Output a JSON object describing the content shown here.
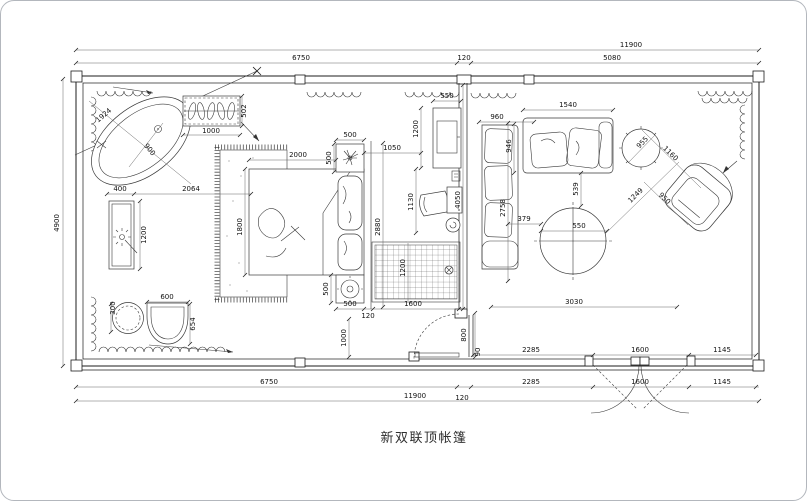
{
  "title": "新双联顶帐篷",
  "dims": {
    "top_overall": "11900",
    "top_left": "6750",
    "top_mid": "120",
    "top_right": "5080",
    "left_height": "4900",
    "bottom_left": "6750",
    "bottom_overall": "11900",
    "bottom_gap": "120",
    "bottom_out_a": "2285",
    "bottom_out_b": "1600",
    "bottom_out_c": "1145",
    "bottom_in_a": "2285",
    "bottom_in_b": "1600",
    "bottom_in_c": "1145",
    "living_width": "3030",
    "living_door": "800",
    "living_door_gap": "90",
    "tub_diag": "1924",
    "tub_width": "900",
    "vanity_offset": "400",
    "vanity_to_rug": "2064",
    "vanity_length": "1200",
    "stool_dia": "300",
    "toilet_width": "600",
    "toilet_depth": "654",
    "wardrobe_width": "1000",
    "wardrobe_depth": "502",
    "bed_length": "2000",
    "bed_width": "1800",
    "nightstand_top_w": "500",
    "nightstand_top_d": "500",
    "nightstand_bot_d": "500",
    "nightstand_bot_w": "500",
    "bed_wall": "2880",
    "tv_offset": "1050",
    "tv_width": "550",
    "tv_height": "1200",
    "desk": "1130",
    "shower_width": "1600",
    "shower_depth": "1200",
    "shower_gap": "120",
    "door_width": "1000",
    "sofa_side": "960",
    "sofa_top": "1540",
    "sofa_depth": "946",
    "partition": "4050",
    "living_depth": "2758",
    "table_offset": "539",
    "table_gap": "379",
    "table_dia": "550",
    "chair_diag": "1249",
    "chair_len": "1160",
    "side_table": "955",
    "chair_width": "950"
  }
}
